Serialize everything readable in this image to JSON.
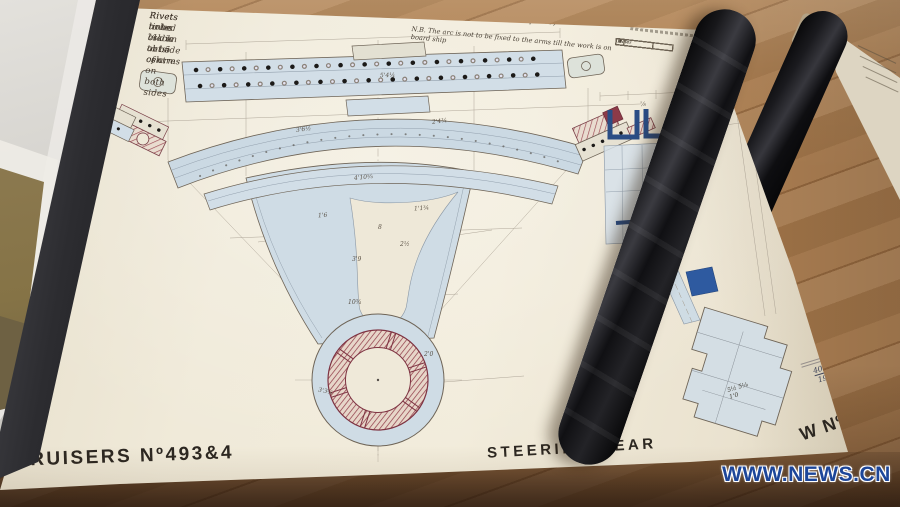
{
  "drawing": {
    "notes_top_left": {
      "line1": "Rivet holes ⅞ dia abt 5 centres",
      "line2": "Rivets to be csk on outside of arm",
      "line3": "Rivets tinted black to be csk on both sides"
    },
    "title_script": "Quadrant  Atlas (Complete)",
    "nb_note": "N.B. The arc is not to be fixed to the arms till the work is on board ship",
    "footer": {
      "left": "CRUISERS Nº493&4",
      "center": "STEERING GEAR",
      "right": "W Nº690V"
    },
    "date_note": {
      "number": "40056",
      "date": "19.3.86"
    },
    "hub_section_marks": {
      "m1": "5½  5⅛",
      "m2": "1'0"
    },
    "table": {
      "row_numbers": [
        "1",
        "2",
        "3",
        "4",
        "5",
        "6"
      ],
      "entries": {
        "r1": "Plates",
        "r2": "Plate"
      }
    },
    "dims": [
      "3'6½",
      "2'4¾",
      "4'10⅝",
      "1'6",
      "1'1¾",
      "3'9",
      "2½",
      "10¾",
      "2'0",
      "3'3¾",
      "8",
      "⅞",
      "5'4¼"
    ],
    "colors": {
      "paper": "#f0ead9",
      "wash_blue": "#cfdce5",
      "section_blue": "#2a4d85",
      "hatch_red": "#95434f",
      "ink": "#6e6457",
      "wood": "#ab7c4d",
      "watermark_blue": "#1d4699"
    }
  },
  "watermark": "WWW.NEWS.CN"
}
